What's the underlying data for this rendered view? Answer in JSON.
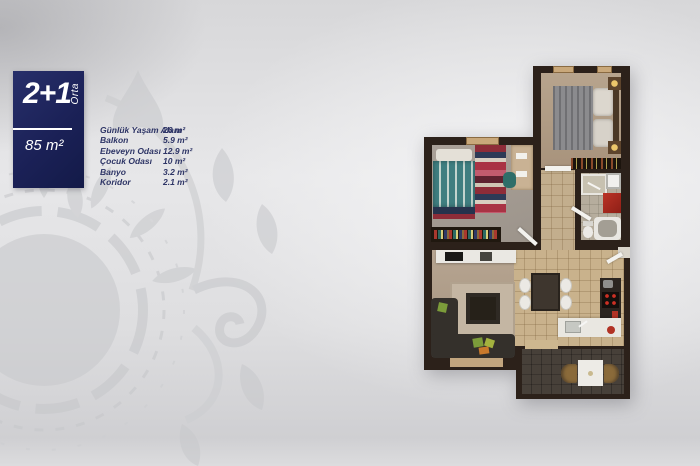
{
  "badge": {
    "title": "2+1",
    "position_label": "Orta",
    "area": "85 m²",
    "background": "#1b2157",
    "text_color": "#ffffff"
  },
  "legend": {
    "text_color": "#2e3566",
    "rows": [
      {
        "label": "Günlük Yaşam Alanı",
        "value": "26 m²"
      },
      {
        "label": "Balkon",
        "value": "5.9 m²"
      },
      {
        "label": "Ebeveyn Odası",
        "value": "12.9 m²"
      },
      {
        "label": "Çocuk Odası",
        "value": "10 m²"
      },
      {
        "label": "Banyo",
        "value": "3.2 m²"
      },
      {
        "label": "Koridor",
        "value": "2.1 m²"
      }
    ]
  },
  "floorplan": {
    "type": "2+1 apartment top-down 3D render",
    "wall_color": "#2c211a",
    "rooms": [
      {
        "name": "Ebeveyn Odası",
        "furniture": [
          "double-bed",
          "nightstand",
          "nightstand",
          "dresser"
        ]
      },
      {
        "name": "Çocuk Odası",
        "furniture": [
          "single-bed",
          "striped-rug",
          "desk",
          "chair",
          "bookshelf"
        ]
      },
      {
        "name": "Banyo",
        "furniture": [
          "shower",
          "white-cabinet",
          "red-cabinet",
          "toilet",
          "bathtub"
        ]
      },
      {
        "name": "Koridor",
        "furniture": [
          "doors"
        ]
      },
      {
        "name": "Günlük Yaşam Alanı",
        "furniture": [
          "kitchen-counter",
          "sofa",
          "coffee-table",
          "rug",
          "dining-table",
          "chairs",
          "stove",
          "sink"
        ]
      },
      {
        "name": "Balkon",
        "furniture": [
          "table",
          "chair",
          "chair"
        ]
      }
    ]
  },
  "watermark": {
    "style": "floral damask ornament",
    "color": "#c7c8cb"
  },
  "background": {
    "base": "#e2e2e4",
    "highlight": "#f4f4f5",
    "shadow": "#cfcfd2"
  }
}
